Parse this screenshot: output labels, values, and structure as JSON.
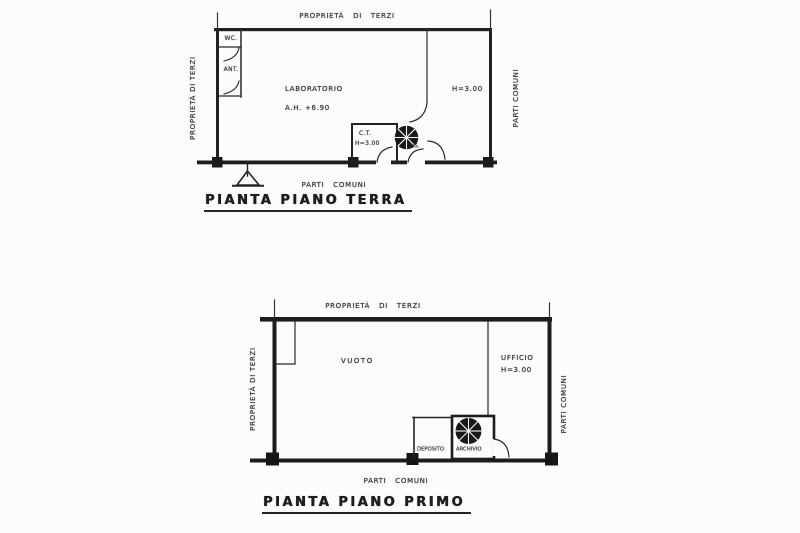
{
  "colors": {
    "ink": "#222222",
    "paper": "#fcfcfa"
  },
  "ground_floor": {
    "title": "PIANTA PIANO TERRA",
    "boundary_labels": {
      "top": "PROPRIETÀ DI TERZI",
      "left": "PROPRIETÀ DI TERZI",
      "right": "PARTI COMUNI",
      "bottom": "PARTI COMUNI"
    },
    "rooms": {
      "wc": "WC.",
      "ant": "ANT.",
      "laboratorio": "LABORATORIO",
      "laboratorio_height": "A.H. +6.90",
      "ct": "C.T.",
      "ct_height": "H=3.00",
      "dis": "DIS.",
      "hall_height": "H=3.00"
    }
  },
  "first_floor": {
    "title": "PIANTA PIANO PRIMO",
    "boundary_labels": {
      "top": "PROPRIETÀ DI TERZI",
      "left": "PROPRIETÀ DI TERZI",
      "right": "PARTI COMUNI",
      "bottom": "PARTI COMUNI"
    },
    "rooms": {
      "vuoto": "VUOTO",
      "ufficio": "UFFICIO",
      "ufficio_height": "H=3.00",
      "deposito": "DEPOSITO",
      "archivio": "ARCHIVIO"
    }
  }
}
